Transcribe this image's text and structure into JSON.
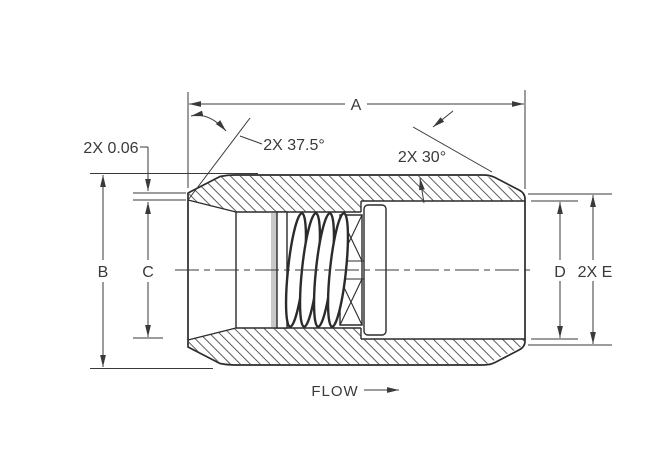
{
  "drawing": {
    "labels": {
      "length_a": "A",
      "diameter_b": "B",
      "diameter_c": "C",
      "diameter_d": "D",
      "diameter_e": "2X E",
      "lip_offset": "2X 0.06",
      "inlet_chamfer_angle": "2X 37.5°",
      "outlet_chamfer_angle": "2X 30°",
      "flow": "FLOW"
    },
    "colors": {
      "background": "#ffffff",
      "object_line": "#2b2b2b",
      "dimension_line": "#3a3a3a",
      "hatch_line": "#4a4a4a",
      "shading": "#c9c9c9"
    }
  }
}
